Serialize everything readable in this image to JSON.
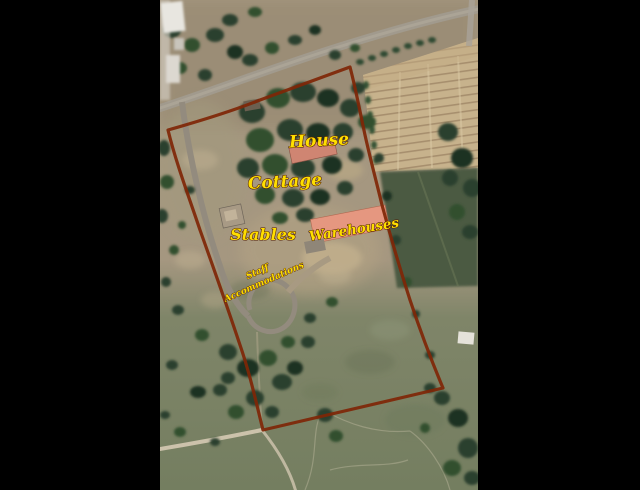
{
  "photo_labels": {
    "house": "House",
    "cottage": "Cottage",
    "stables": "Stables",
    "warehouses": "Warehouses",
    "staff_accommodations_line1": "Staff",
    "staff_accommodations_line2": "Accommodations"
  },
  "colors": {
    "label_text": "#ffdf00",
    "label_outline": "#4f1a04",
    "boundary_line": "#7f2607",
    "letterbox_background": "#000000"
  }
}
